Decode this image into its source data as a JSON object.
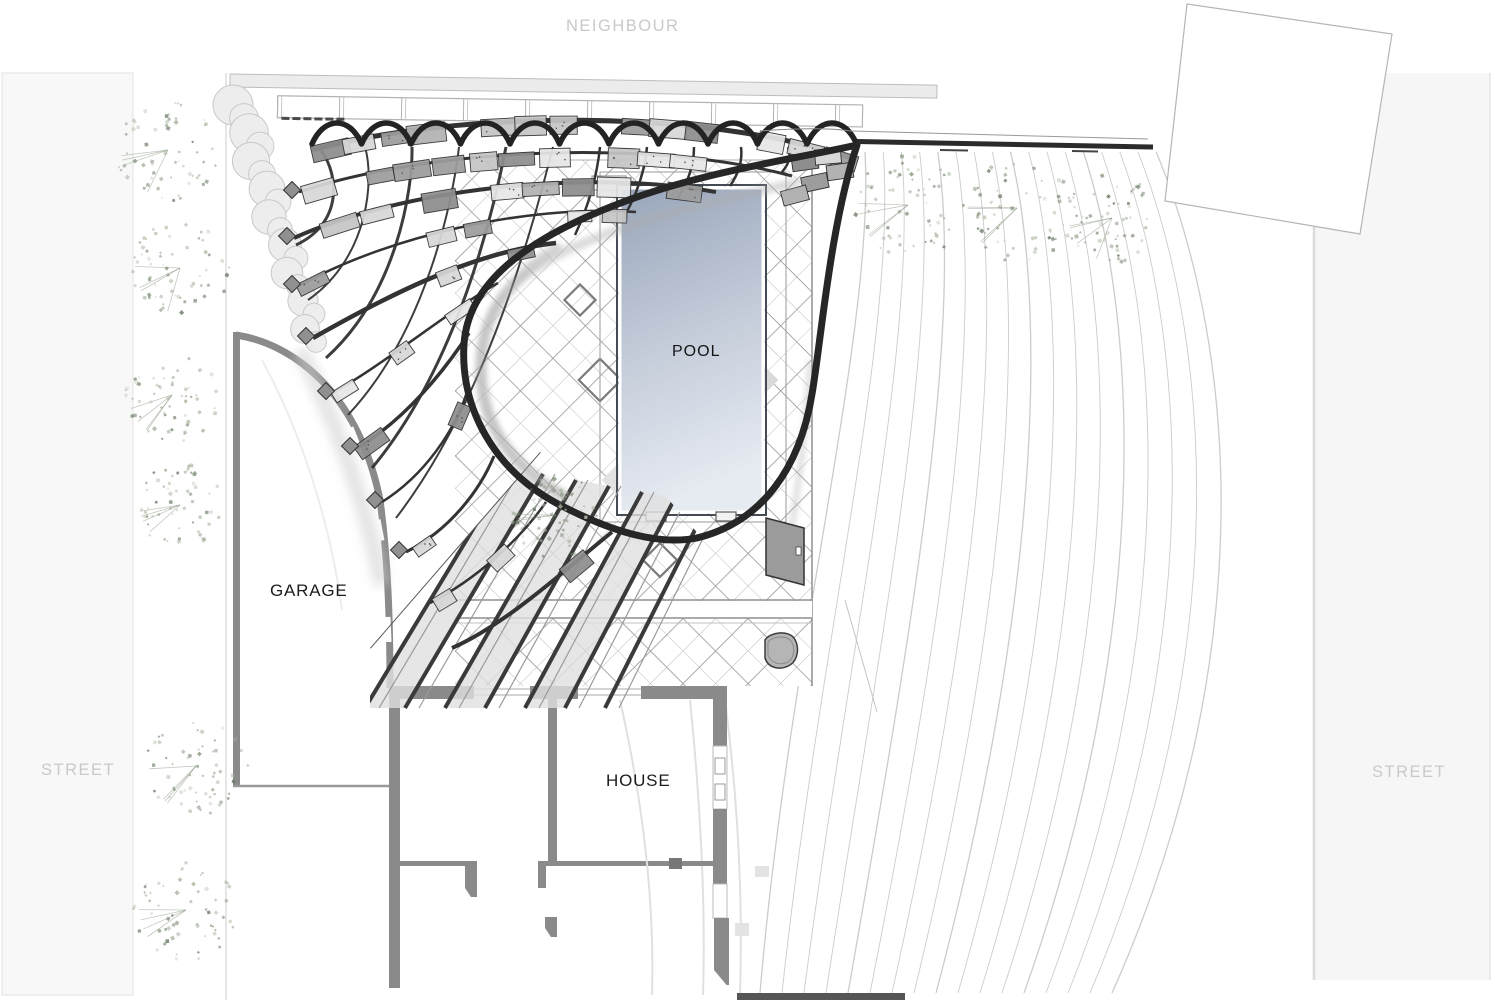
{
  "labels": {
    "neighbour": "NEIGHBOUR",
    "street_left": "STREET",
    "street_right": "STREET",
    "pool": "POOL",
    "garage": "GARAGE",
    "house": "HOUSE"
  },
  "colors": {
    "canopy_dark": "#2b2b2b",
    "lattice": "#333333",
    "wall_gray": "#8a8a8a",
    "wall_dark": "#777777",
    "panel_grays": [
      "#8e8e8e",
      "#9d9d9d",
      "#b2b2b2",
      "#c5c5c5",
      "#d8d8d8",
      "#e7e7e7"
    ],
    "paving_line": "#8f8f8f",
    "paving_line_light": "#bdbdbd",
    "pool_top": "#98a5ba",
    "pool_bottom": "#e6eaf1",
    "pool_edge": "#454b55",
    "field_line": "#c6c6c6",
    "street_band": "#f6f6f7",
    "street_edge": "#dcdcdc",
    "label_gray": "#c9c9c9",
    "label_dark": "#1c1c1c",
    "tree_green_dark": "#6d7d68",
    "tree_green_mid": "#85957e",
    "tree_green_light": "#a4b29b",
    "fence_fill": "#ececec",
    "fence_stroke": "#bdbdbd",
    "hedge_fill": "#ededed",
    "hedge_stroke": "#c6c6c6",
    "shadow_gray": "#adadad",
    "ghost_gray": "#e0e0e0"
  }
}
